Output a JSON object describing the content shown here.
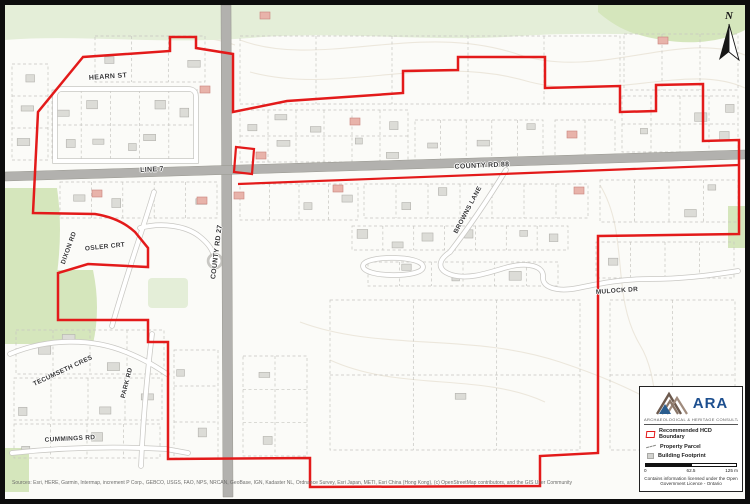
{
  "map": {
    "street_labels": [
      {
        "id": "hearn-st",
        "text": "HEARN ST"
      },
      {
        "id": "line-7",
        "text": "LINE 7"
      },
      {
        "id": "county-rd-88",
        "text": "COUNTY RD 88"
      },
      {
        "id": "county-rd-27",
        "text": "COUNTY RD 27"
      },
      {
        "id": "browns-lane",
        "text": "BROWNS LANE"
      },
      {
        "id": "mulock-dr",
        "text": "MULOCK DR"
      },
      {
        "id": "dixon-rd",
        "text": "DIXON RD"
      },
      {
        "id": "osler-crt",
        "text": "OSLER CRT"
      },
      {
        "id": "tecumseth-cres",
        "text": "TECUMSETH CRES"
      },
      {
        "id": "park-rd",
        "text": "PARK RD"
      },
      {
        "id": "cummings-rd",
        "text": "CUMMINGS RD"
      }
    ],
    "north_label": "N",
    "attribution": "Sources: Esri, HERE, Garmin, Intermap, increment P Corp., GEBCO, USGS, FAO, NPS, NRCAN, GeoBase, IGN, Kadaster NL, Ordnance Survey, Esri Japan, METI, Esri China (Hong Kong), (c) OpenStreetMap contributors, and the GIS User Community"
  },
  "legend": {
    "logo_text": "ARA",
    "logo_tagline": "ARCHAEOLOGICAL & HERITAGE CONSULTANTS",
    "items": [
      {
        "label": "Recommended HCD Boundary",
        "swatch": "red-boundary-outline"
      },
      {
        "label": "Property Parcel",
        "swatch": "dashed-gray-line"
      },
      {
        "label": "Building Footprint",
        "swatch": "gray-square"
      }
    ],
    "scale_bar": {
      "start": "0",
      "mid": "62.5",
      "end": "125 m"
    },
    "credit_line1": "Contains information licensed under the Open",
    "credit_line2": "Government Licence - Ontario"
  },
  "colors": {
    "boundary_red": "#e31a1a",
    "road_fill": "#b2b1ae",
    "road_edge": "#98978f",
    "parcel_line": "#c6c5c0",
    "building_fill": "#dcdcd7",
    "building_accent": "#e8b3aa",
    "green_light": "#e4eed8",
    "green_mid": "#d5e6bc",
    "logo_blue": "#1d4f8f",
    "logo_brown": "#85705f"
  }
}
